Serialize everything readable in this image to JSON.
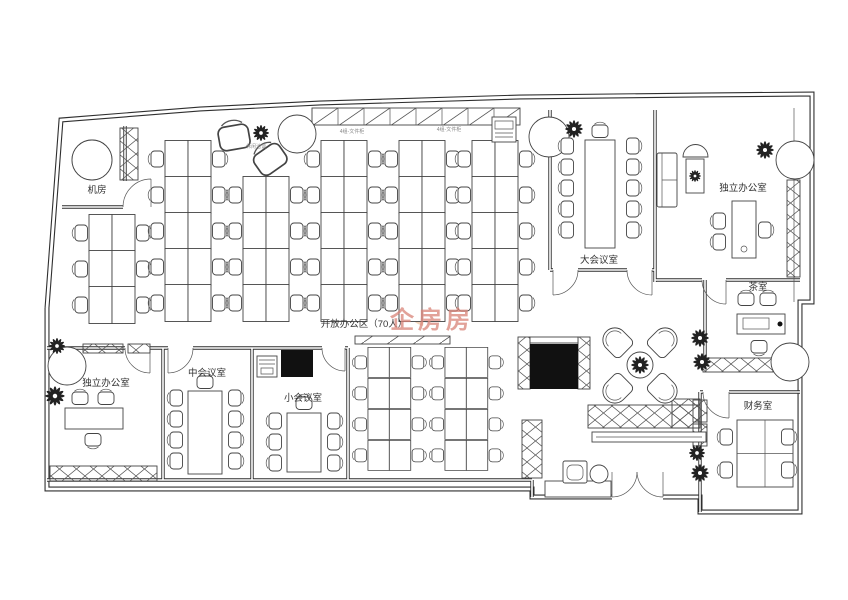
{
  "document": {
    "type": "office-floor-plan"
  },
  "rooms": {
    "machine_room": "机房",
    "open_office": "开放办公区（70人）",
    "large_meeting": "大会议室",
    "private_office_top_right": "独立办公室",
    "tea_room": "茶室",
    "finance_office": "财务室",
    "private_office_bottom_left": "独立办公室",
    "medium_meeting": "中会议室",
    "small_meeting": "小会议室"
  },
  "annotations": {
    "file_cabinet_group_a": "4组-文件柜",
    "file_cabinet_group_b": "4组-文件柜",
    "lounge_area": "休闲洽谈"
  },
  "watermark": {
    "text": "企房房"
  },
  "colors": {
    "line": "#3c3c3c",
    "watermark_text": "#d98378",
    "watermark_logo": "#c3cbdc",
    "watermark_accent": "#e9b286"
  }
}
